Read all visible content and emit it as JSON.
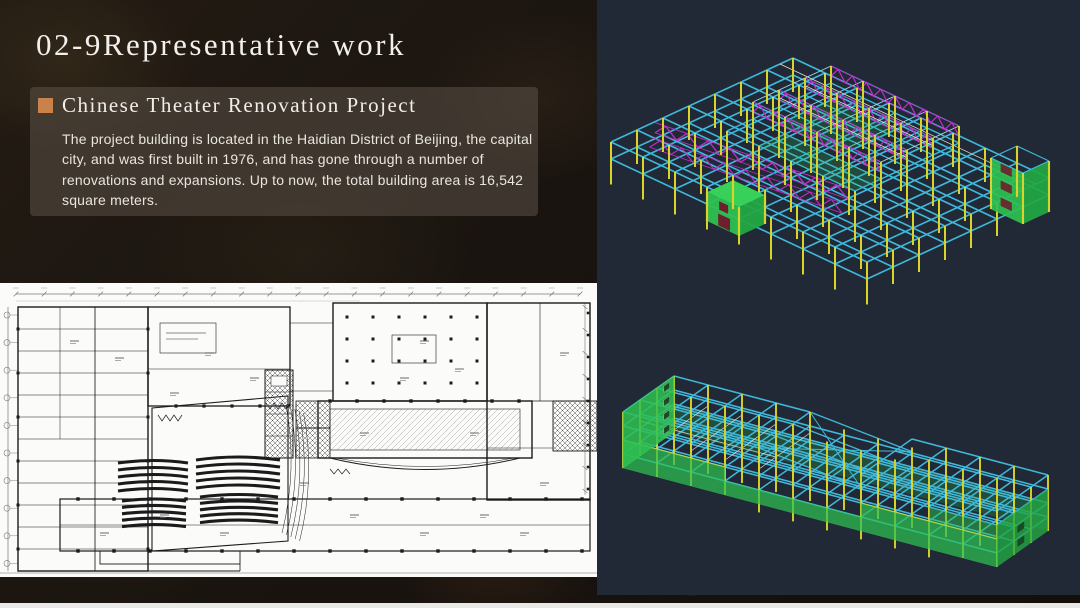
{
  "slide": {
    "title": "02-9Representative work",
    "section": {
      "bullet_color": "#c9824a",
      "heading": "Chinese Theater Renovation Project",
      "body": "The project building is located in the Haidian District of Beijing, the capital city, and was first built in 1976, and has gone through a number of renovations and expansions. Up to now, the total building area is 16,542 square meters."
    }
  },
  "floor_plan": {
    "paper_color": "#fbfbfa",
    "ink_color": "#1b1b1b",
    "hatch_color": "#555555",
    "dim_color": "#777777"
  },
  "cad": {
    "background": "#212936",
    "colors": {
      "beam": "#3fb9dc",
      "beam_light": "#93e0ef",
      "column": "#d9d42b",
      "truss": "#c32cc9",
      "wall": "#2ec151",
      "wall_top": "#37d058",
      "wall_dark": "#23a843",
      "accent": "#e8e2d2",
      "door": "#6e1f2e",
      "window": "#184a26"
    }
  },
  "page": {
    "bottom_edge_color": "#e8e8e6"
  }
}
